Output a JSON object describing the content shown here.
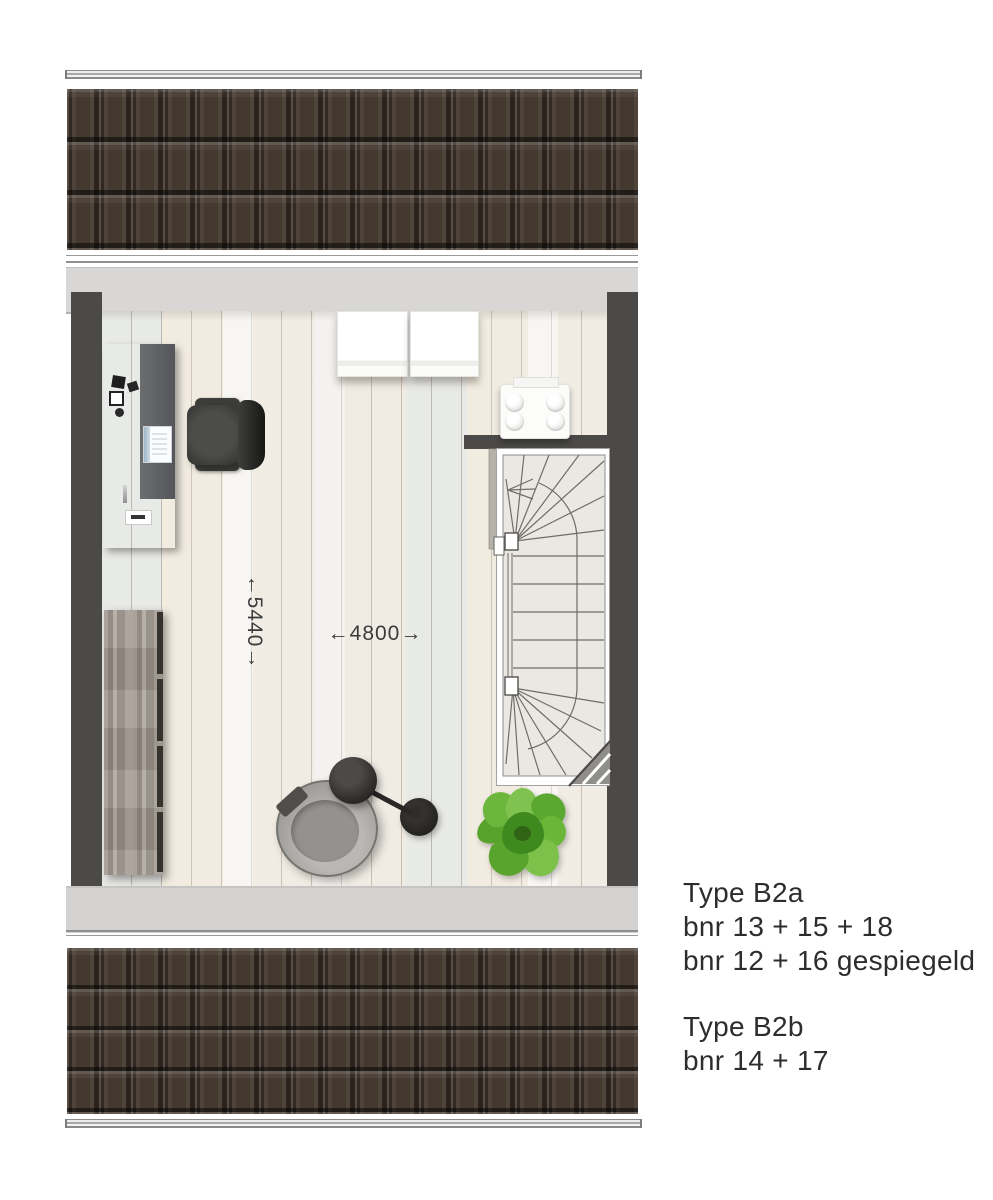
{
  "plan": {
    "type": "attic floor plan",
    "dimensions": {
      "depth_label": "←5440→",
      "width_label": "←4800→"
    },
    "legend": {
      "groups": [
        {
          "title": "Type B2a",
          "lines": [
            "bnr 13 + 15 + 18",
            "bnr 12 + 16 gespiegeld"
          ]
        },
        {
          "title": "Type B2b",
          "lines": [
            "bnr 14 + 17"
          ]
        }
      ]
    },
    "furniture": [
      "roof-tiles",
      "desk",
      "office-chair",
      "washer",
      "dryer",
      "mechanical-unit",
      "staircase",
      "sideboard",
      "lounge-chair",
      "floor-lamp",
      "plant"
    ],
    "colors": {
      "roof_tile": "#44392f",
      "wall_dark": "#4b4a48",
      "wall_band": "#d8d7d5",
      "floor": "#f2efe9",
      "stair_floor": "#eae8e2",
      "plant_green": "#5aa82f",
      "text": "#2d2d2d"
    }
  }
}
